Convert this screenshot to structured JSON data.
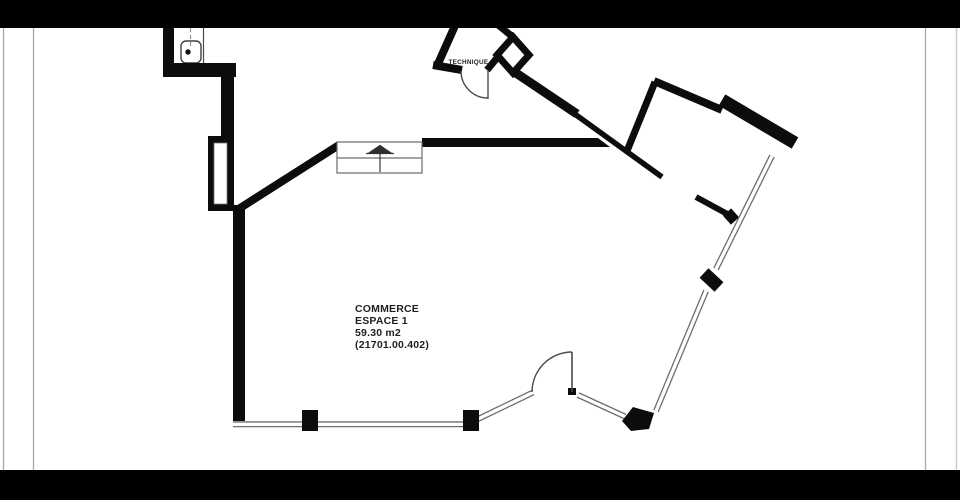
{
  "canvas": {
    "background": "#ffffff"
  },
  "letterbox": {
    "color": "#000000",
    "top_height_px": 28,
    "bottom_height_px": 30
  },
  "palette": {
    "wall": "#0c0c0c",
    "window": "#6e6e6e",
    "door_line": "#4a4a4a",
    "entrance_line": "#6a6a6a",
    "frame_line": "#a9a9a9",
    "frame_line_faint": "#c6c6c6",
    "dash_line": "#909090",
    "fixture_line": "#3f3f3f",
    "text": "#1f1f1f"
  },
  "room_label": {
    "line1": "COMMERCE",
    "line2": "ESPACE 1",
    "line3": "59.30 m2",
    "line4": "(21701.00.402)"
  },
  "technique_label": "TECHNIQUE",
  "symbols": {
    "entrance_arrow": "up-arrow entrance marker",
    "door_swing": "quarter-circle door swing arc",
    "storefront_window": "double-line glazing",
    "utility_fixture": "rounded box with drain dot"
  }
}
